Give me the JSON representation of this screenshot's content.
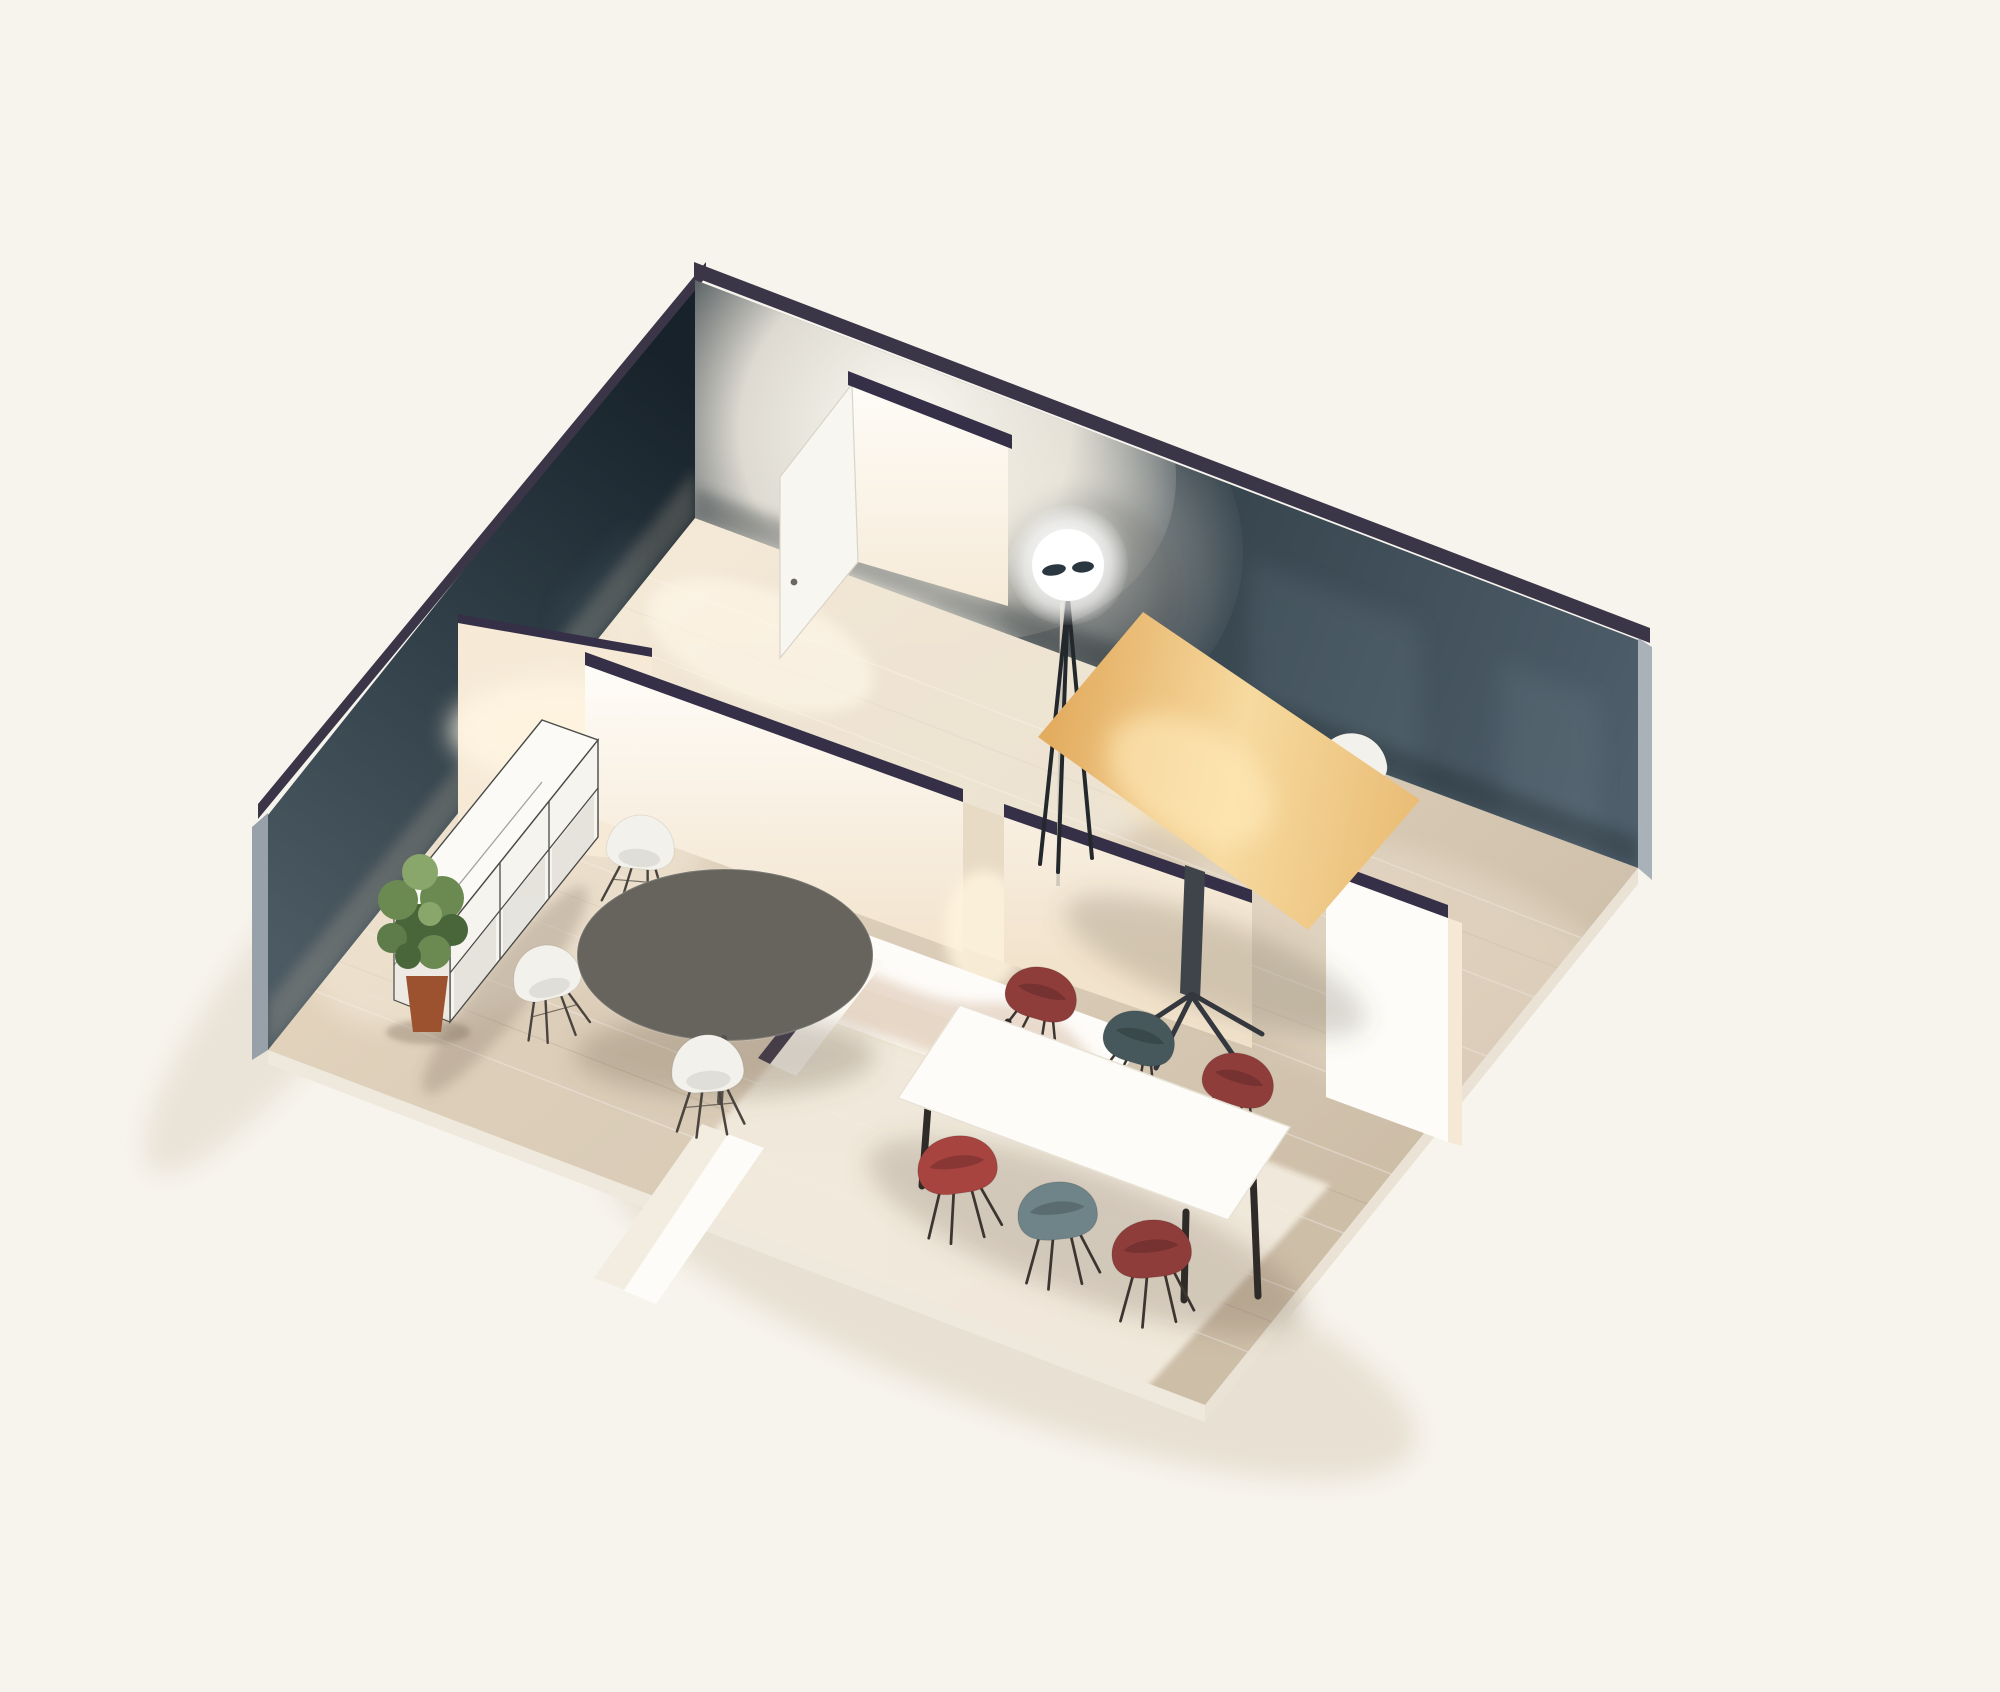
{
  "scene": {
    "kind": "isometric-3d-floor-plan-render",
    "description": "Cutaway axonometric render of a small office apartment with three zones: meeting room, office, dining area",
    "background": "#f7f4ed"
  },
  "palette": {
    "background": "#f7f4ed",
    "wall_cap": "#3b3548",
    "interior_cap": "#353047",
    "wall_nw": "#2e3c45",
    "wall_ne": "#33424b",
    "outer_edge_left": "#98a1a9",
    "outer_edge_right": "#aab2b9",
    "floor_base": "#dccfbb",
    "floor_gap": "#e8dbc5",
    "rug": "#f3ecdf",
    "white_wall": "#fdfbf6",
    "door_white": "#f8f6f0",
    "counter_white": "#fefcf9",
    "counter_front": "#fbf7f0",
    "cut_panel": "#fdfcf8",
    "lit_sliver": "#f5e9d5",
    "cabinet_white": "#fbfaf6",
    "cabinet_front": "#f6f4ee",
    "cabinet_side": "#eceae3",
    "cabinet_glass": "#e3e1da",
    "cabinet_frame": "#4a4a48",
    "round_table": "#67645d",
    "wood_desk": "#ecbd72",
    "desk_base": "#3f434a",
    "lamp_white": "#ffffff",
    "lamp_detail": "#2a3740",
    "lamp_leg": "#23282c",
    "lamp_pole": "#cfc8bb",
    "chair_white": "#f3f1eb",
    "chair_maroon": "#8f3d3b",
    "chair_red": "#a84440",
    "chair_teal": "#46585b",
    "chair_teal_light": "#6e8489",
    "chair_leg": "#4a443e",
    "table_white": "#fdfcf8",
    "table_leg": "#2f2b28",
    "plant_green_dark": "#48663a",
    "plant_green": "#6a8a52",
    "plant_green_light": "#8aa76b",
    "plant_pot": "#9c512f"
  },
  "rooms": [
    {
      "name": "meeting-room",
      "position": "south-west",
      "furniture": [
        "white-sideboard",
        "potted-plant",
        "round-table",
        "white-shell-chair x4"
      ]
    },
    {
      "name": "office",
      "position": "north-east",
      "furniture": [
        "floor-lamp",
        "wooden-desk",
        "white-desk-chair"
      ]
    },
    {
      "name": "dining-area",
      "position": "south-east",
      "furniture": [
        "kitchen-counter",
        "dining-table",
        "maroon-armchair x4",
        "teal-armchair x2",
        "light-rug"
      ]
    }
  ],
  "structure": [
    "back-left-wall",
    "back-right-wall",
    "hall-partition-with-door",
    "open-door-leaf",
    "office-dining-partition-with-doorway",
    "meeting-dining-partition-with-doorway",
    "right-cut-panel",
    "front-cut-panel"
  ]
}
